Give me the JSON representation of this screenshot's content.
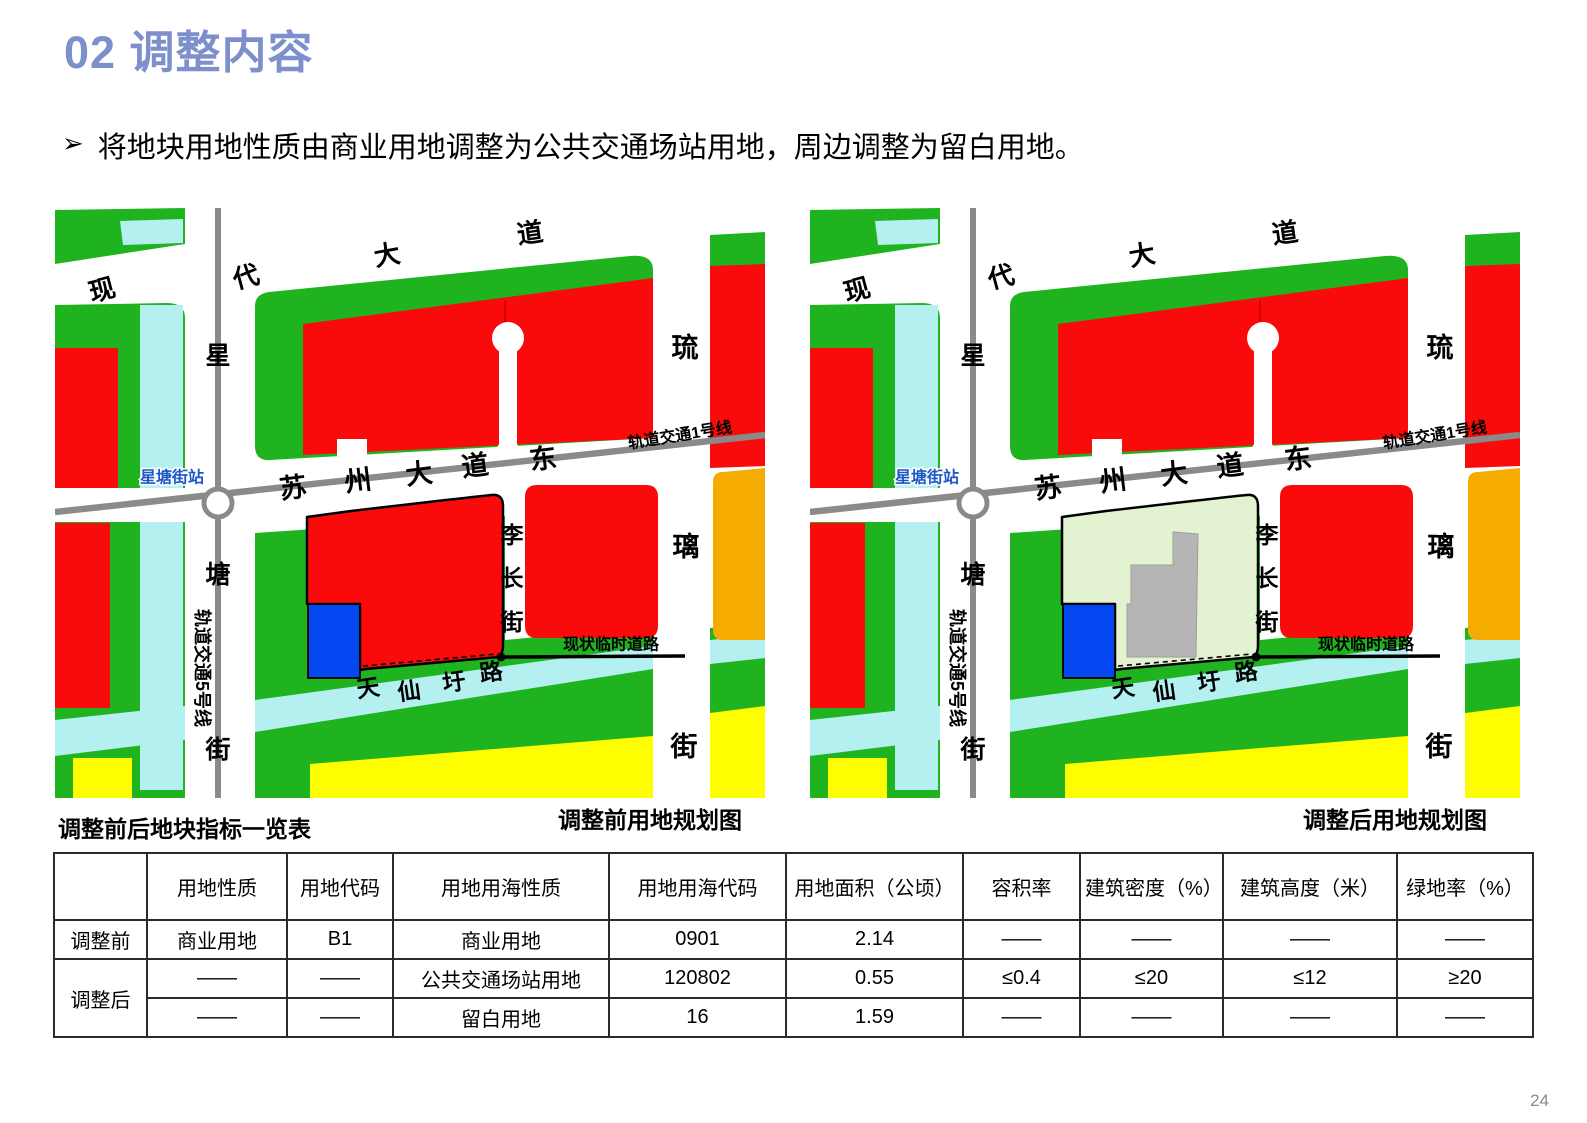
{
  "page": {
    "title": "02 调整内容",
    "bullet_marker": "➢",
    "bullet_text": "将地块用地性质由商业用地调整为公共交通场站用地，周边调整为留白用地。",
    "page_number": "24"
  },
  "captions": {
    "table_title": "调整前后地块指标一览表",
    "before_map": "调整前用地规划图",
    "after_map": "调整后用地规划图"
  },
  "colors": {
    "title_blue": "#7E90CB",
    "red": "#FA0A0A",
    "green": "#1FB41F",
    "cyan": "#B4F0F0",
    "yellow": "#FEFE00",
    "orange": "#F6AB00",
    "blue": "#0347F0",
    "blank_green": "#E3F3D1",
    "building_gray": "#B5B5B5",
    "rail_gray": "#8A8A8A",
    "station_blue": "#1C57C8"
  },
  "map": {
    "legend_note_before": "subject parcel shown as commercial (red)",
    "legend_note_after": "subject parcel shown as reserved blank land (light green) with existing building footprint",
    "labels": [
      {
        "t": "现",
        "x": 47,
        "y": 82,
        "r": -15,
        "s": 26
      },
      {
        "t": "代",
        "x": 191,
        "y": 69,
        "r": -15,
        "s": 26
      },
      {
        "t": "大",
        "x": 332,
        "y": 47,
        "r": -10,
        "s": 26
      },
      {
        "t": "道",
        "x": 475,
        "y": 25,
        "r": -8,
        "s": 26
      },
      {
        "t": "星",
        "x": 163,
        "y": 148,
        "r": 0,
        "s": 25
      },
      {
        "t": "塘",
        "x": 163,
        "y": 367,
        "r": 0,
        "s": 25
      },
      {
        "t": "街",
        "x": 163,
        "y": 542,
        "r": 0,
        "s": 25
      },
      {
        "t": "轨道交通5号线",
        "x": 147,
        "y": 460,
        "r": 90,
        "s": 18
      },
      {
        "t": "苏",
        "x": 238,
        "y": 280,
        "r": -7,
        "s": 27
      },
      {
        "t": "州",
        "x": 303,
        "y": 273,
        "r": -7,
        "s": 27
      },
      {
        "t": "大",
        "x": 364,
        "y": 266,
        "r": -7,
        "s": 27
      },
      {
        "t": "道",
        "x": 420,
        "y": 258,
        "r": -7,
        "s": 27
      },
      {
        "t": "东",
        "x": 488,
        "y": 251,
        "r": -7,
        "s": 27
      },
      {
        "t": "轨道交通1号线",
        "x": 625,
        "y": 228,
        "r": -9,
        "s": 16
      },
      {
        "t": "琉",
        "x": 630,
        "y": 140,
        "r": 0,
        "s": 27
      },
      {
        "t": "璃",
        "x": 631,
        "y": 339,
        "r": 0,
        "s": 27
      },
      {
        "t": "街",
        "x": 629,
        "y": 539,
        "r": 0,
        "s": 27
      },
      {
        "t": "李",
        "x": 457,
        "y": 327,
        "r": 0,
        "s": 23
      },
      {
        "t": "长",
        "x": 457,
        "y": 370,
        "r": 0,
        "s": 23
      },
      {
        "t": "街",
        "x": 457,
        "y": 414,
        "r": 0,
        "s": 23
      },
      {
        "t": "天",
        "x": 313,
        "y": 480,
        "r": -8,
        "s": 23
      },
      {
        "t": "仙",
        "x": 354,
        "y": 483,
        "r": -8,
        "s": 23
      },
      {
        "t": "圩",
        "x": 399,
        "y": 474,
        "r": -8,
        "s": 23
      },
      {
        "t": "路",
        "x": 436,
        "y": 464,
        "r": -8,
        "s": 23
      },
      {
        "t": "现状临时道路",
        "x": 556,
        "y": 437,
        "r": 0,
        "s": 16
      },
      {
        "t": "星塘街站",
        "x": 117,
        "y": 270,
        "r": 0,
        "s": 16,
        "c": "station"
      }
    ]
  },
  "table": {
    "headers": [
      "",
      "用地性质",
      "用地代码",
      "用地用海性质",
      "用地用海代码",
      "用地面积（公顷）",
      "容积率",
      "建筑密度（%）",
      "建筑高度（米）",
      "绿地率（%）"
    ],
    "rows": [
      {
        "label": "调整前",
        "cells": [
          "商业用地",
          "B1",
          "商业用地",
          "0901",
          "2.14",
          "——",
          "——",
          "——",
          "——"
        ]
      },
      {
        "label": "调整后",
        "cells": [
          "——",
          "——",
          "公共交通场站用地",
          "120802",
          "0.55",
          "≤0.4",
          "≤20",
          "≤12",
          "≥20"
        ]
      },
      {
        "label": "",
        "cells": [
          "——",
          "——",
          "留白用地",
          "16",
          "1.59",
          "——",
          "——",
          "——",
          "——"
        ]
      }
    ]
  }
}
